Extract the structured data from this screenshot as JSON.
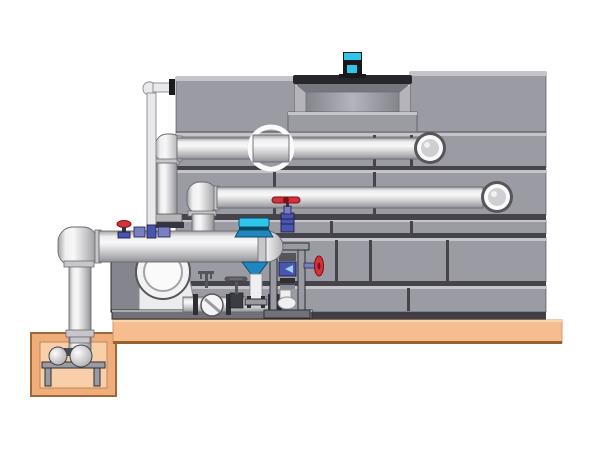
{
  "canvas": {
    "width": 600,
    "height": 450
  },
  "diagram": {
    "type": "technical-illustration",
    "subject": "Cooling tower with fan motor, piping runs, pump skid and sump pit - side elevation",
    "view": "side-elevation",
    "text_labels": []
  },
  "palette": {
    "bg": "#ffffff",
    "towerPanel": "#9b9ba3",
    "towerPanelLight": "#c4c4ca",
    "towerSeam": "#44444a",
    "towerBase": "#3f3f45",
    "recessBack": "#b4b4ba",
    "pipeStroke": "#6a6a70",
    "ringWhite": "#fafafa",
    "ringDark": "#55555b",
    "platform": "#f6bd8e",
    "platformLight": "#fbd4b0",
    "platformEdge": "#9a6030",
    "pitWall": "#f0ad7c",
    "pitInner": "#f8cfa8",
    "pitStroke": "#a06838",
    "steel": "#9a9aa2",
    "steelDark": "#2e2e34",
    "steelMid": "#71717a",
    "valveRed": "#d6303a",
    "valveRedDark": "#7a1018",
    "valveBlue": "#4a55b0",
    "valvePurple": "#7a7fc4",
    "ctrlCyan": "#2ec6ea",
    "ctrlBlue": "#1f86c0",
    "ctrlDark": "#0e4a66",
    "motorDark": "#141418",
    "pumpWhite": "#f2f2f3"
  },
  "components": [
    {
      "id": "cooling-tower",
      "label": "cooling tower casing"
    },
    {
      "id": "fan-cowl",
      "label": "fan discharge cowl"
    },
    {
      "id": "fan-motor",
      "label": "cyan fan motor"
    },
    {
      "id": "upper-horizontal-pipe",
      "label": "upper horizontal pipe run with wall ring"
    },
    {
      "id": "middle-horizontal-pipe",
      "label": "middle horizontal pipe run with wall ring"
    },
    {
      "id": "overflow-standpipe",
      "label": "thin overflow standpipe"
    },
    {
      "id": "suction-header",
      "label": "lower suction header with dome cap"
    },
    {
      "id": "riser-pipe",
      "label": "vertical riser into sump pit"
    },
    {
      "id": "circulation-pump",
      "label": "circulation pump volute"
    },
    {
      "id": "pump-skid",
      "label": "pump skid with strainer and gate valve"
    },
    {
      "id": "strainer",
      "label": "inline strainer sight disc"
    },
    {
      "id": "gate-valve",
      "label": "gate valve with tee handle"
    },
    {
      "id": "control-valve",
      "label": "cyan control valve with flare fitting"
    },
    {
      "id": "globe-valve",
      "label": "globe valve with red handle"
    },
    {
      "id": "handwheel-valve",
      "label": "red handwheel valve on frame"
    },
    {
      "id": "valve-frame",
      "label": "valve support frame"
    },
    {
      "id": "concrete-pad",
      "label": "concrete equipment pad"
    },
    {
      "id": "sump-pit",
      "label": "sump pit"
    },
    {
      "id": "sump-pump",
      "label": "sump pump on stand"
    }
  ]
}
